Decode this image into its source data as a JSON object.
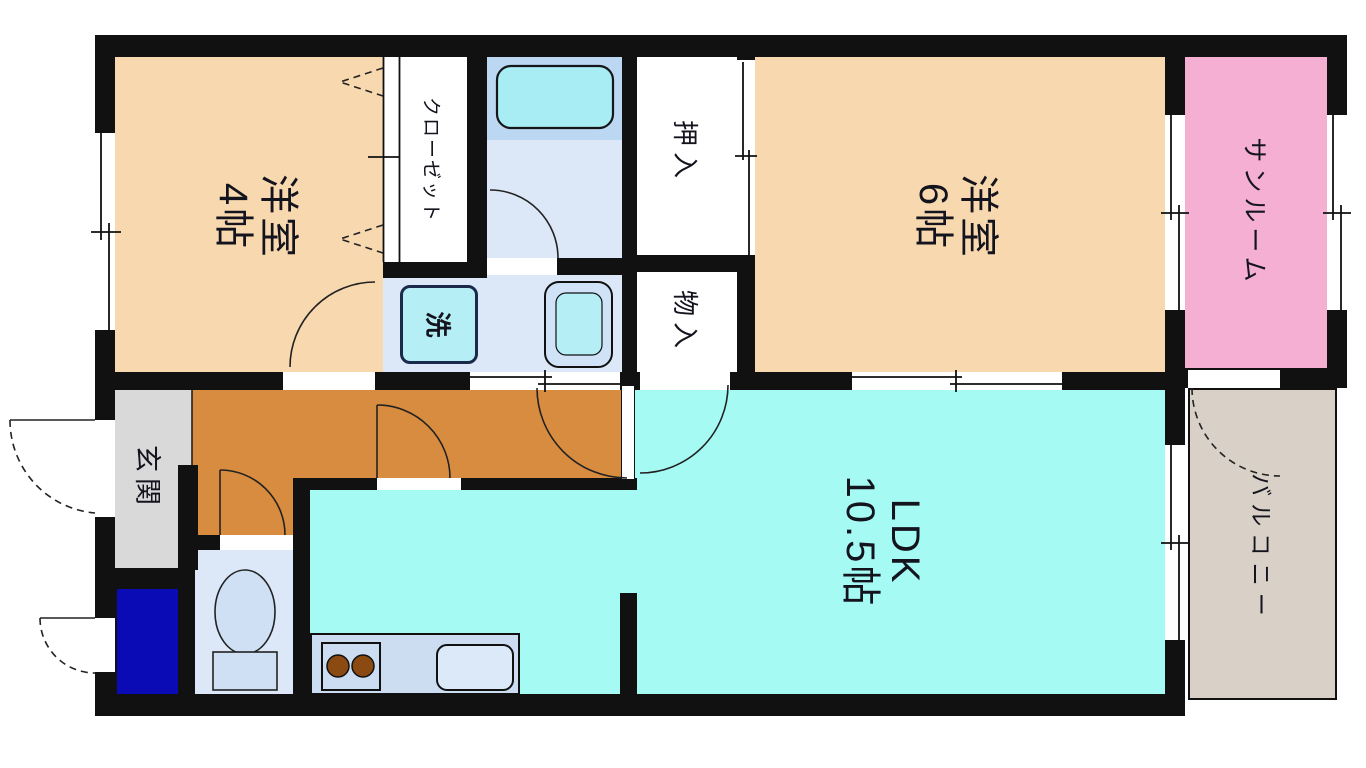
{
  "rooms": {
    "western4": {
      "line1": "洋室",
      "line2": "4帖",
      "color": "#F8D8AF"
    },
    "western6": {
      "line1": "洋室",
      "line2": "6帖",
      "color": "#F8D8AF"
    },
    "ldk": {
      "line1": "LDK",
      "line2": "10.5帖",
      "color": "#A5FAF4"
    },
    "closet": {
      "label": "クローゼット",
      "color": "#FFFFFF"
    },
    "oshiire": {
      "label": "押入",
      "color": "#FFFFFF"
    },
    "monoire": {
      "label": "物入",
      "color": "#FFFFFF"
    },
    "sunroom": {
      "label": "サンルーム",
      "color": "#F4AFD3"
    },
    "balcony": {
      "label": "バルコニー",
      "color": "#D9D0C7"
    },
    "genkan": {
      "label": "玄関",
      "color": "#D9D9D9"
    },
    "hallway": {
      "color": "#D78C3F"
    },
    "bathroom": {
      "color": "#DCE8F7",
      "upper_color": "#BCD7F1",
      "tub_color": "#A9EDF4"
    },
    "washroom": {
      "washer_label": "洗",
      "color": "#DCE8F7",
      "washer_box_color": "#B5EEF5"
    },
    "toilet": {
      "color": "#DCE8F7",
      "fixture_color": "#CFE0F5"
    },
    "storage_blue": {
      "color": "#0B0BB5"
    },
    "kitchen": {
      "counter_color": "#CCDDF1",
      "burner_color": "#8A4A12",
      "sink_color": "#DCE9F9"
    }
  },
  "colors": {
    "wall": "#111111",
    "text": "#14141E",
    "background": "#FFFFFF"
  }
}
